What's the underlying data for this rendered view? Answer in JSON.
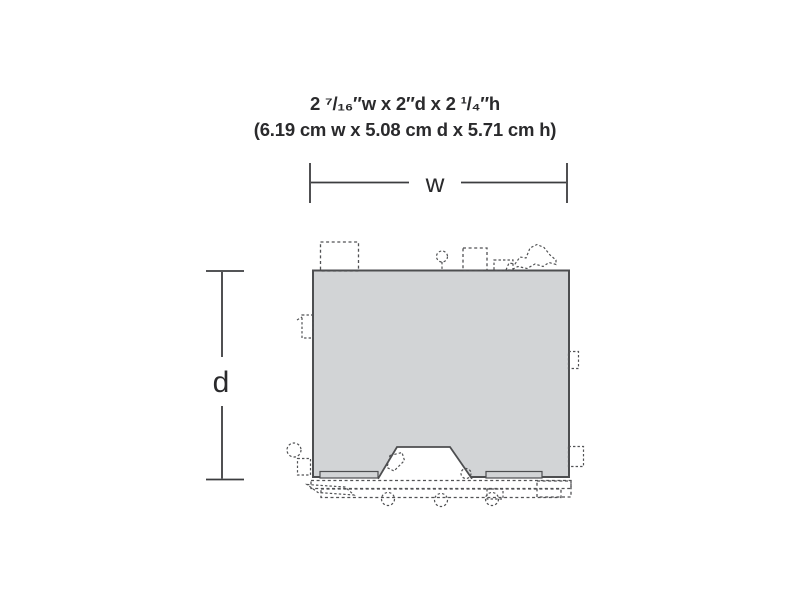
{
  "title": {
    "dimensions_imperial": "2 ⁷/₁₆″w x 2″d x 2 ¹/₄″h",
    "dimensions_metric": "(6.19 cm w x 5.08 cm d x 5.71 cm h)"
  },
  "dimension_labels": {
    "width": "w",
    "depth": "d"
  },
  "footprint": {
    "fill": "#d2d4d6",
    "outline": "#4d4e50"
  },
  "colors": {
    "background": "#ffffff",
    "text": "#2a2a2c",
    "dimension_line": "#3c3d3f",
    "dashed_detail": "#515254"
  }
}
